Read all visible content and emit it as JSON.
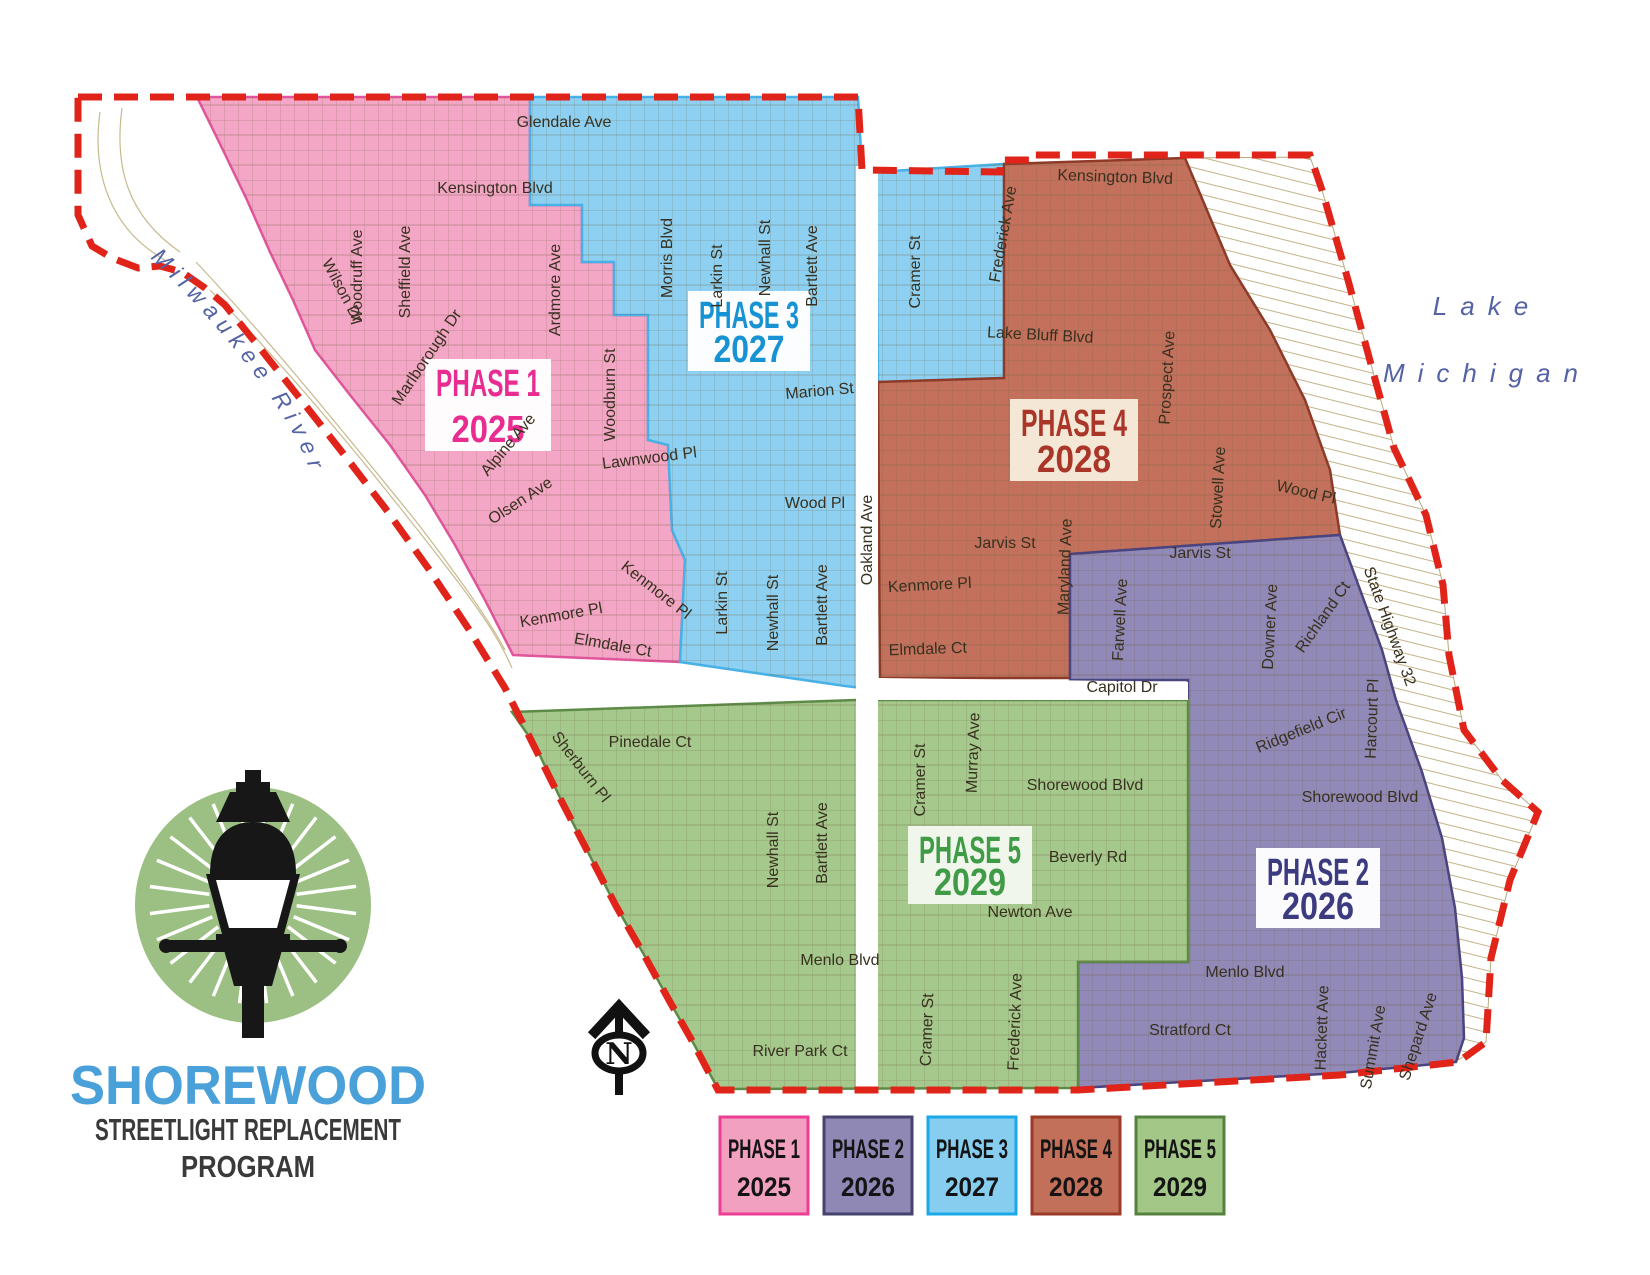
{
  "title_block": {
    "name": "SHOREWOOD",
    "subtitle1": "STREETLIGHT REPLACEMENT",
    "subtitle2": "PROGRAM",
    "name_color": "#4aa0d8",
    "subtitle_color": "#3a3a3a"
  },
  "logo": {
    "circle_fill": "#9cc083",
    "lamp_color": "#171717",
    "ray_color": "#ffffff",
    "ray_count": 24
  },
  "compass": {
    "letter": "N",
    "color": "#111111"
  },
  "map": {
    "boundary_color": "#e0241a",
    "street_text_color": "#38301f",
    "water_text_color": "#5463a5",
    "parcel_line_color": "#6b5b39",
    "bluff_hatch_color": "#c3b388"
  },
  "water": {
    "river": "Milwaukee River",
    "lake1": "Lake",
    "lake2": "Michigan"
  },
  "phases": [
    {
      "label": "PHASE 1",
      "year": "2025",
      "region_fill": "#f3a6c5",
      "region_stroke": "#e0559b",
      "text_color": "#e82c90",
      "box": {
        "x": 488,
        "y": 405,
        "w": 126,
        "h": 92,
        "fill": "#ffffff"
      }
    },
    {
      "label": "PHASE 2",
      "year": "2026",
      "region_fill": "#9189b8",
      "region_stroke": "#4a4480",
      "text_color": "#3c3b80",
      "box": {
        "x": 1318,
        "y": 888,
        "w": 124,
        "h": 80,
        "fill": "#ffffff"
      }
    },
    {
      "label": "PHASE 3",
      "year": "2027",
      "region_fill": "#8dd0f1",
      "region_stroke": "#48b2e8",
      "text_color": "#1793d3",
      "box": {
        "x": 749,
        "y": 331,
        "w": 122,
        "h": 80,
        "fill": "#ffffff"
      }
    },
    {
      "label": "PHASE 4",
      "year": "2028",
      "region_fill": "#c3715c",
      "region_stroke": "#8e3a28",
      "text_color": "#a93628",
      "box": {
        "x": 1074,
        "y": 440,
        "w": 128,
        "h": 82,
        "fill": "#f7ecdc"
      }
    },
    {
      "label": "PHASE 5",
      "year": "2029",
      "region_fill": "#a5c98c",
      "region_stroke": "#5d8b47",
      "text_color": "#3f9b45",
      "box": {
        "x": 970,
        "y": 865,
        "w": 124,
        "h": 78,
        "fill": "#f3f8ee"
      }
    }
  ],
  "legend": {
    "x0": 720,
    "y": 1117,
    "box_w": 88,
    "box_h": 97,
    "gap": 16,
    "items": [
      {
        "label": "PHASE 1",
        "year": "2025",
        "fill": "#f2a0c0",
        "border": "#ee3d95"
      },
      {
        "label": "PHASE 2",
        "year": "2026",
        "fill": "#8f88b5",
        "border": "#45426e"
      },
      {
        "label": "PHASE 3",
        "year": "2027",
        "fill": "#86cdf0",
        "border": "#19a9e9"
      },
      {
        "label": "PHASE 4",
        "year": "2028",
        "fill": "#c3705a",
        "border": "#9c3a28"
      },
      {
        "label": "PHASE 5",
        "year": "2029",
        "fill": "#a2c787",
        "border": "#55813f"
      }
    ]
  },
  "street_labels": [
    {
      "t": "Glendale Ave",
      "x": 564,
      "y": 127,
      "r": 0
    },
    {
      "t": "Kensington Blvd",
      "x": 495,
      "y": 193,
      "r": 0
    },
    {
      "t": "Woodruff Ave",
      "x": 362,
      "y": 277,
      "r": -90
    },
    {
      "t": "Sheffield Ave",
      "x": 410,
      "y": 272,
      "r": -90
    },
    {
      "t": "Wilson Dr",
      "x": 338,
      "y": 293,
      "r": 62
    },
    {
      "t": "Marlborough Dr",
      "x": 431,
      "y": 360,
      "r": -56
    },
    {
      "t": "Ardmore Ave",
      "x": 560,
      "y": 290,
      "r": -90
    },
    {
      "t": "Woodburn St",
      "x": 615,
      "y": 395,
      "r": -90
    },
    {
      "t": "Alpine Ave",
      "x": 512,
      "y": 448,
      "r": -50
    },
    {
      "t": "Olsen Ave",
      "x": 523,
      "y": 505,
      "r": -33
    },
    {
      "t": "Lawnwood Pl",
      "x": 650,
      "y": 463,
      "r": -7
    },
    {
      "t": "Kenmore Pl",
      "x": 653,
      "y": 594,
      "r": 38
    },
    {
      "t": "Kenmore Pl",
      "x": 562,
      "y": 620,
      "r": -10
    },
    {
      "t": "Elmdale Ct",
      "x": 612,
      "y": 650,
      "r": 10
    },
    {
      "t": "Morris Blvd",
      "x": 672,
      "y": 258,
      "r": -90
    },
    {
      "t": "Larkin St",
      "x": 722,
      "y": 276,
      "r": -90
    },
    {
      "t": "Newhall St",
      "x": 770,
      "y": 258,
      "r": -90
    },
    {
      "t": "Bartlett Ave",
      "x": 817,
      "y": 266,
      "r": -90
    },
    {
      "t": "Marion St",
      "x": 820,
      "y": 396,
      "r": -5
    },
    {
      "t": "Wood Pl",
      "x": 815,
      "y": 508,
      "r": 0
    },
    {
      "t": "Larkin St",
      "x": 727,
      "y": 603,
      "r": -90
    },
    {
      "t": "Newhall St",
      "x": 778,
      "y": 613,
      "r": -90
    },
    {
      "t": "Bartlett Ave",
      "x": 827,
      "y": 605,
      "r": -90
    },
    {
      "t": "Oakland Ave",
      "x": 872,
      "y": 540,
      "r": -90
    },
    {
      "t": "Cramer St",
      "x": 920,
      "y": 272,
      "r": -90
    },
    {
      "t": "Lake Bluff Blvd",
      "x": 1040,
      "y": 340,
      "r": 3
    },
    {
      "t": "Kensington Blvd",
      "x": 1115,
      "y": 182,
      "r": 2
    },
    {
      "t": "Frederick Ave",
      "x": 1008,
      "y": 235,
      "r": -80
    },
    {
      "t": "Prospect Ave",
      "x": 1172,
      "y": 378,
      "r": -87
    },
    {
      "t": "Stowell Ave",
      "x": 1223,
      "y": 488,
      "r": -87
    },
    {
      "t": "Wood Pl",
      "x": 1305,
      "y": 497,
      "r": 13
    },
    {
      "t": "Jarvis St",
      "x": 1005,
      "y": 548,
      "r": 0
    },
    {
      "t": "Kenmore Pl",
      "x": 930,
      "y": 590,
      "r": -3
    },
    {
      "t": "Elmdale Ct",
      "x": 928,
      "y": 654,
      "r": -2
    },
    {
      "t": "Maryland Ave",
      "x": 1070,
      "y": 567,
      "r": -88
    },
    {
      "t": "Jarvis St",
      "x": 1200,
      "y": 558,
      "r": 0
    },
    {
      "t": "Farwell Ave",
      "x": 1125,
      "y": 620,
      "r": -87
    },
    {
      "t": "Downer Ave",
      "x": 1275,
      "y": 627,
      "r": -87
    },
    {
      "t": "Richland Ct",
      "x": 1327,
      "y": 620,
      "r": -55
    },
    {
      "t": "State Highway 32",
      "x": 1385,
      "y": 628,
      "r": 70
    },
    {
      "t": "Harcourt Pl",
      "x": 1377,
      "y": 719,
      "r": -88
    },
    {
      "t": "Ridgefield Cir",
      "x": 1303,
      "y": 735,
      "r": -22
    },
    {
      "t": "Capitol Dr",
      "x": 1122,
      "y": 692,
      "r": 0
    },
    {
      "t": "Shorewood Blvd",
      "x": 1360,
      "y": 802,
      "r": 0
    },
    {
      "t": "Menlo Blvd",
      "x": 1245,
      "y": 977,
      "r": 0
    },
    {
      "t": "Stratford Ct",
      "x": 1190,
      "y": 1035,
      "r": 0
    },
    {
      "t": "Hackett Ave",
      "x": 1327,
      "y": 1028,
      "r": -88
    },
    {
      "t": "Summit Ave",
      "x": 1378,
      "y": 1048,
      "r": -80
    },
    {
      "t": "Shepard Ave",
      "x": 1423,
      "y": 1038,
      "r": -72
    },
    {
      "t": "Pinedale Ct",
      "x": 650,
      "y": 747,
      "r": 0
    },
    {
      "t": "Sherburn Pl",
      "x": 577,
      "y": 770,
      "r": 52
    },
    {
      "t": "Newhall St",
      "x": 778,
      "y": 850,
      "r": -90
    },
    {
      "t": "Bartlett Ave",
      "x": 827,
      "y": 843,
      "r": -90
    },
    {
      "t": "Cramer St",
      "x": 925,
      "y": 780,
      "r": -90
    },
    {
      "t": "Murray Ave",
      "x": 978,
      "y": 753,
      "r": -88
    },
    {
      "t": "Shorewood Blvd",
      "x": 1085,
      "y": 790,
      "r": 0
    },
    {
      "t": "Beverly Rd",
      "x": 1088,
      "y": 862,
      "r": 0
    },
    {
      "t": "Newton Ave",
      "x": 1030,
      "y": 917,
      "r": 0
    },
    {
      "t": "Menlo Blvd",
      "x": 840,
      "y": 965,
      "r": 0
    },
    {
      "t": "River Park Ct",
      "x": 800,
      "y": 1056,
      "r": 0
    },
    {
      "t": "Cramer St",
      "x": 932,
      "y": 1030,
      "r": -88
    },
    {
      "t": "Frederick Ave",
      "x": 1020,
      "y": 1022,
      "r": -88
    }
  ]
}
